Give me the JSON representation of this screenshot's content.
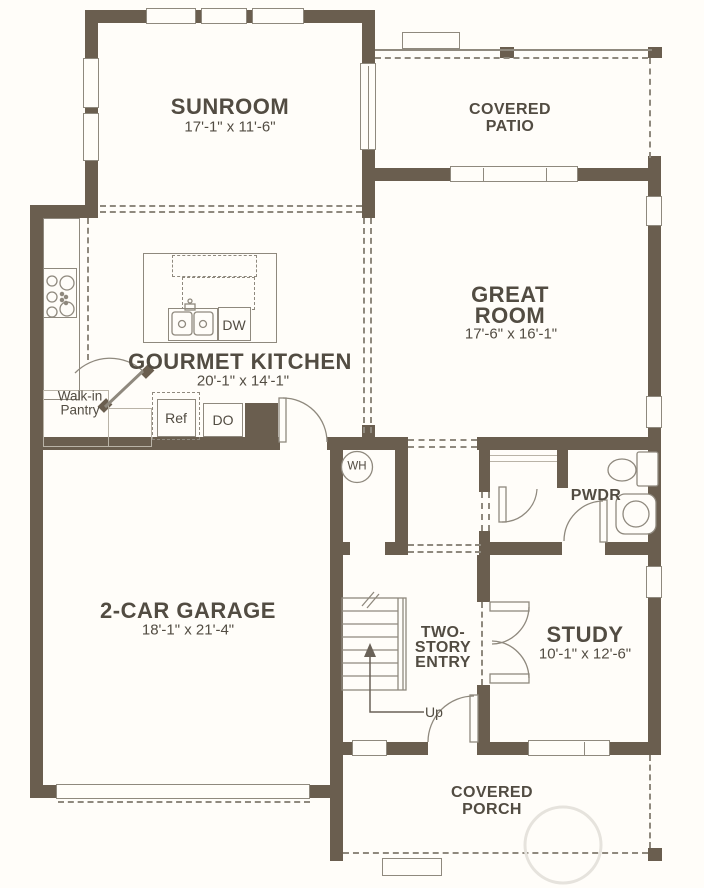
{
  "colors": {
    "wall": "#6a5e4f",
    "thin_line": "#8f897e",
    "text": "#524c42",
    "background": "#fffdf9"
  },
  "rooms": {
    "sunroom": {
      "label": "SUNROOM",
      "dims": "17'-1\" x 11'-6\""
    },
    "covered_patio": {
      "label_line1": "COVERED",
      "label_line2": "PATIO"
    },
    "great_room": {
      "label_line1": "GREAT",
      "label_line2": "ROOM",
      "dims": "17'-6\" x 16'-1\""
    },
    "gourmet_kitchen": {
      "label": "GOURMET KITCHEN",
      "dims": "20'-1\" x 14'-1\""
    },
    "walk_in_pantry": {
      "label_line1": "Walk-in",
      "label_line2": "Pantry"
    },
    "garage": {
      "label": "2-CAR GARAGE",
      "dims": "18'-1\" x 21'-4\""
    },
    "two_story_entry": {
      "label_line1": "TWO-",
      "label_line2": "STORY",
      "label_line3": "ENTRY"
    },
    "study": {
      "label": "STUDY",
      "dims": "10'-1\" x 12'-6\""
    },
    "powder_room": {
      "label": "PWDR"
    },
    "covered_porch": {
      "label_line1": "COVERED",
      "label_line2": "PORCH"
    }
  },
  "fixtures": {
    "refrigerator": "Ref",
    "double_oven": "DO",
    "dishwasher": "DW",
    "water_heater": "WH",
    "stairs_direction": "Up"
  }
}
